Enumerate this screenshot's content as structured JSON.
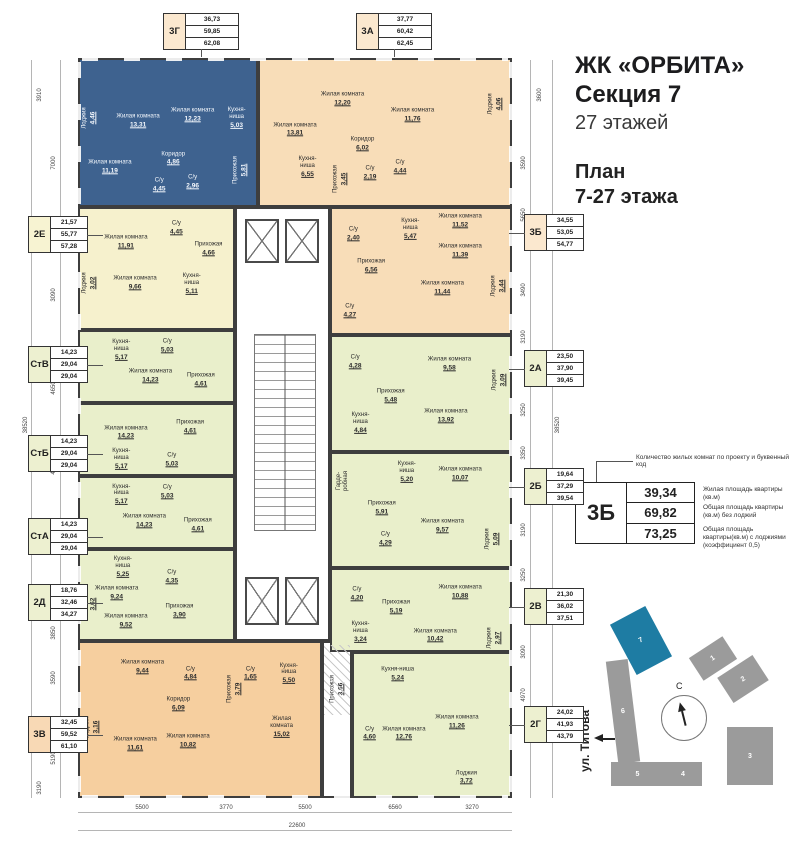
{
  "title": {
    "project": "ЖК «ОРБИТА»",
    "section": "Секция 7",
    "floors": "27 этажей",
    "plan1": "План",
    "plan2": "7-27 этажа"
  },
  "legend": {
    "note": "Количество жилых комнат по проекту и буквенный код",
    "code": "3Б",
    "v1": "39,34",
    "v2": "69,82",
    "v3": "73,25",
    "d1": "Жилая площадь квартиры (кв.м)",
    "d2": "Общая площадь квартиры (кв.м) без лоджий",
    "d3": "Общая площадь квартиры(кв.м) с лоджиями (коэффициент 0,5)"
  },
  "minimap": {
    "street": "ул. Титова",
    "compass": "С",
    "sections": [
      {
        "label": "1",
        "x": 693,
        "y": 645,
        "w": 40,
        "h": 27,
        "r": -33,
        "hl": false
      },
      {
        "label": "2",
        "x": 722,
        "y": 664,
        "w": 42,
        "h": 30,
        "r": -33,
        "hl": false
      },
      {
        "label": "3",
        "x": 727,
        "y": 727,
        "w": 46,
        "h": 58,
        "r": 0,
        "hl": false
      },
      {
        "label": "4",
        "x": 664,
        "y": 762,
        "w": 38,
        "h": 24,
        "r": 0,
        "hl": false
      },
      {
        "label": "5",
        "x": 611,
        "y": 762,
        "w": 53,
        "h": 24,
        "r": 0,
        "hl": false
      },
      {
        "label": "6",
        "x": 612,
        "y": 660,
        "w": 22,
        "h": 103,
        "r": -7,
        "hl": false
      },
      {
        "label": "7",
        "x": 621,
        "y": 612,
        "w": 40,
        "h": 57,
        "r": -28,
        "hl": true
      }
    ]
  },
  "callouts": [
    {
      "code": "3Г",
      "vals": [
        "36,73",
        "59,85",
        "62,08"
      ],
      "x": 163,
      "y": 13,
      "side": "top",
      "fill": "cream"
    },
    {
      "code": "3А",
      "vals": [
        "37,77",
        "60,42",
        "62,45"
      ],
      "x": 356,
      "y": 13,
      "side": "top",
      "fill": "cream"
    },
    {
      "code": "2Е",
      "vals": [
        "21,57",
        "55,77",
        "57,28"
      ],
      "x": 28,
      "y": 216,
      "side": "left",
      "fill": "yellow"
    },
    {
      "code": "СтВ",
      "vals": [
        "14,23",
        "29,04",
        "29,04"
      ],
      "x": 28,
      "y": 346,
      "side": "left",
      "fill": "green"
    },
    {
      "code": "СтБ",
      "vals": [
        "14,23",
        "29,04",
        "29,04"
      ],
      "x": 28,
      "y": 435,
      "side": "left",
      "fill": "green"
    },
    {
      "code": "СтА",
      "vals": [
        "14,23",
        "29,04",
        "29,04"
      ],
      "x": 28,
      "y": 518,
      "side": "left",
      "fill": "green"
    },
    {
      "code": "2Д",
      "vals": [
        "18,76",
        "32,46",
        "34,27"
      ],
      "x": 28,
      "y": 584,
      "side": "left",
      "fill": "green"
    },
    {
      "code": "3В",
      "vals": [
        "32,45",
        "59,52",
        "61,10"
      ],
      "x": 28,
      "y": 716,
      "side": "left",
      "fill": "orange"
    },
    {
      "code": "3Б",
      "vals": [
        "34,55",
        "53,05",
        "54,77"
      ],
      "x": 524,
      "y": 214,
      "side": "right",
      "fill": "cream"
    },
    {
      "code": "2А",
      "vals": [
        "23,50",
        "37,90",
        "39,45"
      ],
      "x": 524,
      "y": 350,
      "side": "right",
      "fill": "green"
    },
    {
      "code": "2Б",
      "vals": [
        "19,64",
        "37,29",
        "39,54"
      ],
      "x": 524,
      "y": 468,
      "side": "right",
      "fill": "green"
    },
    {
      "code": "2В",
      "vals": [
        "21,30",
        "36,02",
        "37,51"
      ],
      "x": 524,
      "y": 588,
      "side": "right",
      "fill": "green"
    },
    {
      "code": "2Г",
      "vals": [
        "24,02",
        "41,93",
        "43,79"
      ],
      "x": 524,
      "y": 706,
      "side": "right",
      "fill": "green"
    }
  ],
  "apartments": [
    {
      "code": "3Г",
      "fill": "blue",
      "x": 78,
      "y": 58,
      "w": 180,
      "h": 149,
      "rooms": [
        {
          "n": "Лоджия",
          "a": "4,46",
          "x": 5,
          "y": 40,
          "v": true
        },
        {
          "n": "Жилая комната",
          "a": "13,31",
          "x": 33,
          "y": 42
        },
        {
          "n": "Жилая комната",
          "a": "12,23",
          "x": 64,
          "y": 38
        },
        {
          "n": "Кухня-\nниша",
          "a": "5,03",
          "x": 89,
          "y": 40
        },
        {
          "n": "Коридор",
          "a": "4,86",
          "x": 53,
          "y": 68
        },
        {
          "n": "Жилая комната",
          "a": "11,19",
          "x": 17,
          "y": 74
        },
        {
          "n": "С/у",
          "a": "4,45",
          "x": 45,
          "y": 86
        },
        {
          "n": "С/у",
          "a": "2,96",
          "x": 64,
          "y": 84
        },
        {
          "n": "Прихожая",
          "a": "5,81",
          "x": 91,
          "y": 76,
          "v": true
        }
      ]
    },
    {
      "code": "3А",
      "fill": "cream",
      "x": 258,
      "y": 58,
      "w": 254,
      "h": 149,
      "rooms": [
        {
          "n": "Жилая комната",
          "a": "13,81",
          "x": 14,
          "y": 48
        },
        {
          "n": "Жилая комната",
          "a": "12,20",
          "x": 33,
          "y": 27
        },
        {
          "n": "Жилая комната",
          "a": "11,76",
          "x": 61,
          "y": 38
        },
        {
          "n": "Лоджия",
          "a": "4,06",
          "x": 94,
          "y": 30,
          "v": true
        },
        {
          "n": "Коридор",
          "a": "6,02",
          "x": 41,
          "y": 58
        },
        {
          "n": "Кухня-\nниша",
          "a": "6,55",
          "x": 19,
          "y": 74
        },
        {
          "n": "Прихожая",
          "a": "3,45",
          "x": 32,
          "y": 82,
          "v": true
        },
        {
          "n": "С/у",
          "a": "2,19",
          "x": 44,
          "y": 78
        },
        {
          "n": "С/у",
          "a": "4,44",
          "x": 56,
          "y": 74
        }
      ]
    },
    {
      "code": "2Е",
      "fill": "yellow",
      "x": 78,
      "y": 207,
      "w": 157,
      "h": 123,
      "rooms": [
        {
          "n": "Жилая комната",
          "a": "11,91",
          "x": 30,
          "y": 28
        },
        {
          "n": "С/у",
          "a": "4,45",
          "x": 63,
          "y": 16
        },
        {
          "n": "Прихожая",
          "a": "4,66",
          "x": 84,
          "y": 34
        },
        {
          "n": "Лоджия",
          "a": "3,02",
          "x": 6,
          "y": 62,
          "v": true
        },
        {
          "n": "Жилая комната",
          "a": "9,66",
          "x": 36,
          "y": 62
        },
        {
          "n": "Кухня-\nниша",
          "a": "5,11",
          "x": 73,
          "y": 63
        }
      ]
    },
    {
      "code": "СтВ",
      "fill": "green",
      "x": 78,
      "y": 330,
      "w": 157,
      "h": 73,
      "rooms": [
        {
          "n": "Кухня-\nниша",
          "a": "5,17",
          "x": 27,
          "y": 26
        },
        {
          "n": "С/у",
          "a": "5,03",
          "x": 57,
          "y": 20
        },
        {
          "n": "Жилая комната",
          "a": "14,23",
          "x": 46,
          "y": 64
        },
        {
          "n": "Прихожая",
          "a": "4,61",
          "x": 79,
          "y": 70
        }
      ]
    },
    {
      "code": "СтБ",
      "fill": "green",
      "x": 78,
      "y": 403,
      "w": 157,
      "h": 73,
      "rooms": [
        {
          "n": "Жилая комната",
          "a": "14,23",
          "x": 30,
          "y": 40
        },
        {
          "n": "Прихожая",
          "a": "4,61",
          "x": 72,
          "y": 32
        },
        {
          "n": "Кухня-\nниша",
          "a": "5,17",
          "x": 27,
          "y": 78
        },
        {
          "n": "С/у",
          "a": "5,03",
          "x": 60,
          "y": 80
        }
      ]
    },
    {
      "code": "СтА",
      "fill": "green",
      "x": 78,
      "y": 476,
      "w": 157,
      "h": 73,
      "rooms": [
        {
          "n": "Кухня-\nниша",
          "a": "5,17",
          "x": 27,
          "y": 24
        },
        {
          "n": "С/у",
          "a": "5,03",
          "x": 57,
          "y": 20
        },
        {
          "n": "Жилая комната",
          "a": "14,23",
          "x": 42,
          "y": 62
        },
        {
          "n": "Прихожая",
          "a": "4,61",
          "x": 77,
          "y": 68
        }
      ]
    },
    {
      "code": "2Д",
      "fill": "green",
      "x": 78,
      "y": 549,
      "w": 157,
      "h": 92,
      "rooms": [
        {
          "n": "Кухня-\nниша",
          "a": "5,25",
          "x": 28,
          "y": 18
        },
        {
          "n": "Жилая комната",
          "a": "9,24",
          "x": 24,
          "y": 48
        },
        {
          "n": "С/у",
          "a": "4,35",
          "x": 60,
          "y": 30
        },
        {
          "n": "Лоджия",
          "a": "3,62",
          "x": 6,
          "y": 60,
          "v": true
        },
        {
          "n": "Жилая комната",
          "a": "9,52",
          "x": 30,
          "y": 80
        },
        {
          "n": "Прихожая",
          "a": "3,90",
          "x": 65,
          "y": 68
        }
      ]
    },
    {
      "code": "3В",
      "fill": "orange",
      "x": 78,
      "y": 641,
      "w": 244,
      "h": 157,
      "rooms": [
        {
          "n": "Жилая комната",
          "a": "9,44",
          "x": 26,
          "y": 16
        },
        {
          "n": "С/у",
          "a": "4,84",
          "x": 46,
          "y": 20
        },
        {
          "n": "Коридор",
          "a": "6,09",
          "x": 41,
          "y": 40
        },
        {
          "n": "Лоджия",
          "a": "3,16",
          "x": 5,
          "y": 55,
          "v": true
        },
        {
          "n": "Жилая комната",
          "a": "11,61",
          "x": 23,
          "y": 66
        },
        {
          "n": "Жилая комната",
          "a": "10,82",
          "x": 45,
          "y": 64
        },
        {
          "n": "Прихожая",
          "a": "3,79",
          "x": 64,
          "y": 30,
          "v": true
        },
        {
          "n": "С/у",
          "a": "1,65",
          "x": 71,
          "y": 20
        },
        {
          "n": "Кухня-ниша",
          "a": "5,50",
          "x": 87,
          "y": 20
        },
        {
          "n": "Жилая комната",
          "a": "15,02",
          "x": 84,
          "y": 55
        }
      ]
    },
    {
      "code": "вход",
      "fill": "white",
      "x": 322,
      "y": 641,
      "w": 30,
      "h": 157,
      "rooms": [
        {
          "n": "Прихожая",
          "a": "3,66",
          "x": 50,
          "y": 30,
          "v": true
        }
      ]
    },
    {
      "code": "3Б",
      "fill": "cream",
      "x": 330,
      "y": 207,
      "w": 182,
      "h": 128,
      "rooms": [
        {
          "n": "Жилая комната",
          "a": "11,52",
          "x": 72,
          "y": 10
        },
        {
          "n": "С/у",
          "a": "2,40",
          "x": 12,
          "y": 20
        },
        {
          "n": "Кухня-\nниша",
          "a": "5,47",
          "x": 44,
          "y": 16
        },
        {
          "n": "Жилая комната",
          "a": "11,39",
          "x": 72,
          "y": 34
        },
        {
          "n": "Прихожая",
          "a": "6,56",
          "x": 22,
          "y": 46
        },
        {
          "n": "Жилая комната",
          "a": "11,44",
          "x": 62,
          "y": 64
        },
        {
          "n": "Лоджия",
          "a": "3,44",
          "x": 93,
          "y": 62,
          "v": true
        },
        {
          "n": "С/у",
          "a": "4,27",
          "x": 10,
          "y": 82
        }
      ]
    },
    {
      "code": "2А",
      "fill": "green",
      "x": 330,
      "y": 335,
      "w": 182,
      "h": 117,
      "rooms": [
        {
          "n": "С/у",
          "a": "4,28",
          "x": 13,
          "y": 22
        },
        {
          "n": "Жилая комната",
          "a": "9,58",
          "x": 66,
          "y": 24
        },
        {
          "n": "Лоджия",
          "a": "3,09",
          "x": 94,
          "y": 38,
          "v": true
        },
        {
          "n": "Прихожая",
          "a": "5,48",
          "x": 33,
          "y": 52
        },
        {
          "n": "Кухня-\nниша",
          "a": "4,84",
          "x": 16,
          "y": 76
        },
        {
          "n": "Жилая комната",
          "a": "13,92",
          "x": 64,
          "y": 70
        }
      ]
    },
    {
      "code": "2Б",
      "fill": "green",
      "x": 330,
      "y": 452,
      "w": 182,
      "h": 116,
      "rooms": [
        {
          "n": "Гарде-\nробная",
          "a": "",
          "x": 6,
          "y": 24,
          "v": true
        },
        {
          "n": "Кухня-\nниша",
          "a": "5,20",
          "x": 42,
          "y": 16
        },
        {
          "n": "Жилая комната",
          "a": "10,07",
          "x": 72,
          "y": 18
        },
        {
          "n": "Прихожая",
          "a": "5,91",
          "x": 28,
          "y": 48
        },
        {
          "n": "С/у",
          "a": "4,29",
          "x": 30,
          "y": 76
        },
        {
          "n": "Жилая комната",
          "a": "9,57",
          "x": 62,
          "y": 64
        },
        {
          "n": "Лоджия",
          "a": "5,09",
          "x": 90,
          "y": 76,
          "v": true
        }
      ]
    },
    {
      "code": "2В",
      "fill": "green",
      "x": 330,
      "y": 568,
      "w": 182,
      "h": 84,
      "rooms": [
        {
          "n": "С/у",
          "a": "4,20",
          "x": 14,
          "y": 30
        },
        {
          "n": "Прихожая",
          "a": "5,19",
          "x": 36,
          "y": 46
        },
        {
          "n": "Жилая комната",
          "a": "10,88",
          "x": 72,
          "y": 28
        },
        {
          "n": "Кухня-\nниша",
          "a": "3,24",
          "x": 16,
          "y": 78
        },
        {
          "n": "Жилая комната",
          "a": "10,42",
          "x": 58,
          "y": 82
        },
        {
          "n": "Лоджия",
          "a": "2,97",
          "x": 91,
          "y": 85,
          "v": true
        }
      ]
    },
    {
      "code": "2Г",
      "fill": "green",
      "x": 352,
      "y": 652,
      "w": 160,
      "h": 146,
      "rooms": [
        {
          "n": "Кухня-ниша",
          "a": "5,24",
          "x": 28,
          "y": 14
        },
        {
          "n": "С/у",
          "a": "4,60",
          "x": 10,
          "y": 56
        },
        {
          "n": "Жилая комната",
          "a": "12,76",
          "x": 32,
          "y": 56
        },
        {
          "n": "Жилая комната",
          "a": "11,26",
          "x": 66,
          "y": 48
        },
        {
          "n": "Лоджия",
          "a": "3,72",
          "x": 72,
          "y": 87
        }
      ]
    }
  ],
  "dimensions": [
    {
      "t": "3910",
      "x": 40,
      "y": 95,
      "v": true
    },
    {
      "t": "7000",
      "x": 54,
      "y": 163,
      "v": true
    },
    {
      "t": "3090",
      "x": 54,
      "y": 295,
      "v": true
    },
    {
      "t": "4650",
      "x": 54,
      "y": 388,
      "v": true
    },
    {
      "t": "4650",
      "x": 54,
      "y": 468,
      "v": true
    },
    {
      "t": "4650",
      "x": 54,
      "y": 548,
      "v": true
    },
    {
      "t": "38520",
      "x": 26,
      "y": 425,
      "v": true
    },
    {
      "t": "3850",
      "x": 54,
      "y": 633,
      "v": true
    },
    {
      "t": "3590",
      "x": 54,
      "y": 678,
      "v": true
    },
    {
      "t": "5190",
      "x": 54,
      "y": 758,
      "v": true
    },
    {
      "t": "3190",
      "x": 40,
      "y": 788,
      "v": true
    },
    {
      "t": "3600",
      "x": 540,
      "y": 95,
      "v": true
    },
    {
      "t": "3590",
      "x": 524,
      "y": 163,
      "v": true
    },
    {
      "t": "5650",
      "x": 524,
      "y": 215,
      "v": true
    },
    {
      "t": "3490",
      "x": 524,
      "y": 290,
      "v": true
    },
    {
      "t": "3190",
      "x": 524,
      "y": 337,
      "v": true
    },
    {
      "t": "3250",
      "x": 524,
      "y": 410,
      "v": true
    },
    {
      "t": "3350",
      "x": 524,
      "y": 453,
      "v": true
    },
    {
      "t": "38520",
      "x": 558,
      "y": 425,
      "v": true
    },
    {
      "t": "3190",
      "x": 524,
      "y": 530,
      "v": true
    },
    {
      "t": "3250",
      "x": 524,
      "y": 575,
      "v": true
    },
    {
      "t": "3090",
      "x": 524,
      "y": 652,
      "v": true
    },
    {
      "t": "4970",
      "x": 524,
      "y": 695,
      "v": true
    },
    {
      "t": "5500",
      "x": 142,
      "y": 808,
      "v": false
    },
    {
      "t": "3770",
      "x": 226,
      "y": 808,
      "v": false
    },
    {
      "t": "5500",
      "x": 305,
      "y": 808,
      "v": false
    },
    {
      "t": "6560",
      "x": 395,
      "y": 808,
      "v": false
    },
    {
      "t": "3270",
      "x": 472,
      "y": 808,
      "v": false
    },
    {
      "t": "22600",
      "x": 297,
      "y": 826,
      "v": false
    }
  ]
}
